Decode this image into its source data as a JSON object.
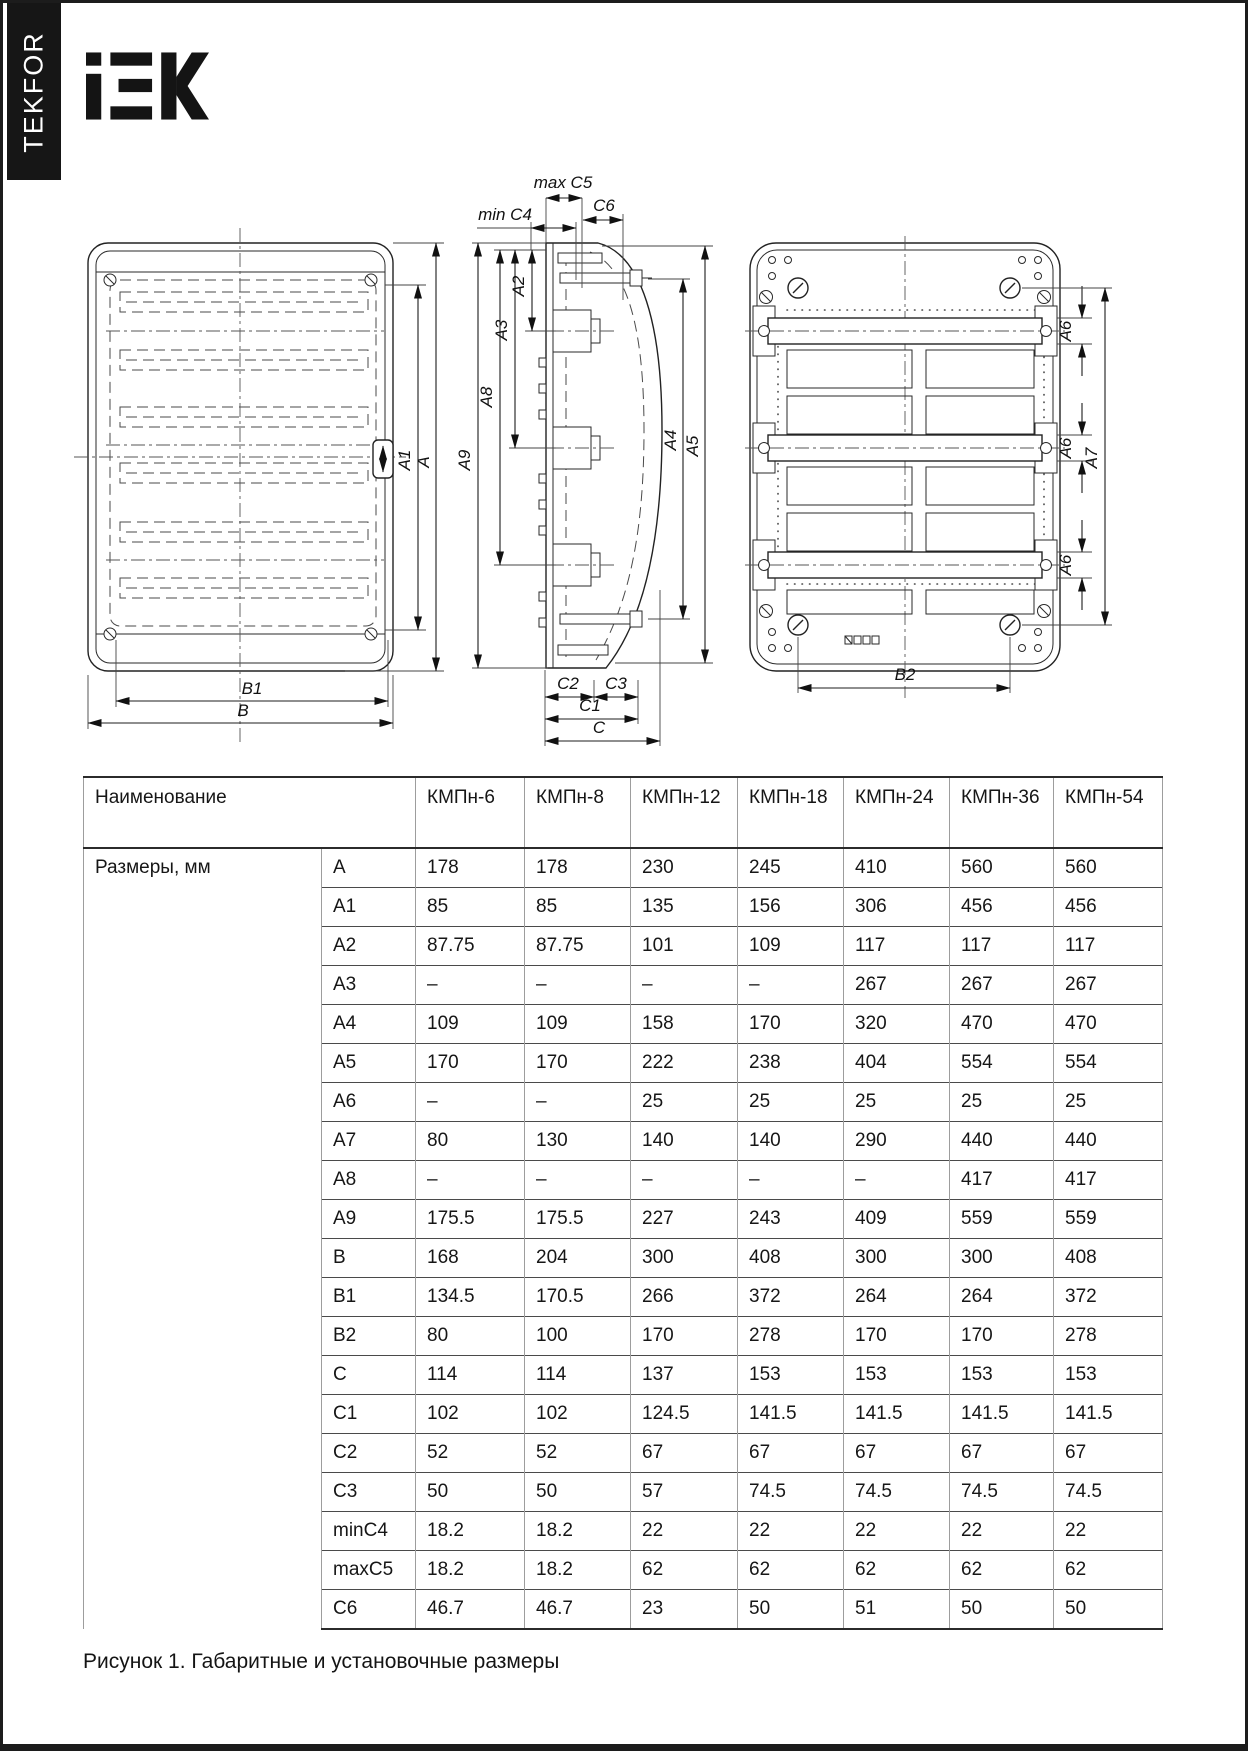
{
  "page": {
    "brand_vertical": "TEKFOR",
    "logo_text": "iEK",
    "caption": "Рисунок 1. Габаритные и установочные размеры"
  },
  "dims": {
    "A": "A",
    "A1": "A1",
    "A2": "A2",
    "A3": "A3",
    "A4": "A4",
    "A5": "A5",
    "A6": "A6",
    "A7": "A7",
    "A8": "A8",
    "A9": "A9",
    "B": "B",
    "B1": "B1",
    "B2": "B2",
    "C": "C",
    "C1": "C1",
    "C2": "C2",
    "C3": "C3",
    "minC4": "min C4",
    "maxC5": "max C5",
    "C6": "C6"
  },
  "table": {
    "name_header": "Наименование",
    "models": [
      "КМПн-6",
      "КМПн-8",
      "КМПн-12",
      "КМПн-18",
      "КМПн-24",
      "КМПн-36",
      "КМПн-54"
    ],
    "group_label": "Размеры, мм",
    "rows": [
      {
        "dim": "A",
        "values": [
          "178",
          "178",
          "230",
          "245",
          "410",
          "560",
          "560"
        ]
      },
      {
        "dim": "A1",
        "values": [
          "85",
          "85",
          "135",
          "156",
          "306",
          "456",
          "456"
        ]
      },
      {
        "dim": "A2",
        "values": [
          "87.75",
          "87.75",
          "101",
          "109",
          "117",
          "117",
          "117"
        ]
      },
      {
        "dim": "A3",
        "values": [
          "–",
          "–",
          "–",
          "–",
          "267",
          "267",
          "267"
        ]
      },
      {
        "dim": "A4",
        "values": [
          "109",
          "109",
          "158",
          "170",
          "320",
          "470",
          "470"
        ]
      },
      {
        "dim": "A5",
        "values": [
          "170",
          "170",
          "222",
          "238",
          "404",
          "554",
          "554"
        ]
      },
      {
        "dim": "A6",
        "values": [
          "–",
          "–",
          "25",
          "25",
          "25",
          "25",
          "25"
        ]
      },
      {
        "dim": "A7",
        "values": [
          "80",
          "130",
          "140",
          "140",
          "290",
          "440",
          "440"
        ]
      },
      {
        "dim": "A8",
        "values": [
          "–",
          "–",
          "–",
          "–",
          "–",
          "417",
          "417"
        ]
      },
      {
        "dim": "A9",
        "values": [
          "175.5",
          "175.5",
          "227",
          "243",
          "409",
          "559",
          "559"
        ]
      },
      {
        "dim": "B",
        "values": [
          "168",
          "204",
          "300",
          "408",
          "300",
          "300",
          "408"
        ]
      },
      {
        "dim": "B1",
        "values": [
          "134.5",
          "170.5",
          "266",
          "372",
          "264",
          "264",
          "372"
        ]
      },
      {
        "dim": "B2",
        "values": [
          "80",
          "100",
          "170",
          "278",
          "170",
          "170",
          "278"
        ]
      },
      {
        "dim": "C",
        "values": [
          "114",
          "114",
          "137",
          "153",
          "153",
          "153",
          "153"
        ]
      },
      {
        "dim": "C1",
        "values": [
          "102",
          "102",
          "124.5",
          "141.5",
          "141.5",
          "141.5",
          "141.5"
        ]
      },
      {
        "dim": "C2",
        "values": [
          "52",
          "52",
          "67",
          "67",
          "67",
          "67",
          "67"
        ]
      },
      {
        "dim": "C3",
        "values": [
          "50",
          "50",
          "57",
          "74.5",
          "74.5",
          "74.5",
          "74.5"
        ]
      },
      {
        "dim": "minC4",
        "values": [
          "18.2",
          "18.2",
          "22",
          "22",
          "22",
          "22",
          "22"
        ]
      },
      {
        "dim": "maxC5",
        "values": [
          "18.2",
          "18.2",
          "62",
          "62",
          "62",
          "62",
          "62"
        ]
      },
      {
        "dim": "C6",
        "values": [
          "46.7",
          "46.7",
          "23",
          "50",
          "51",
          "50",
          "50"
        ]
      }
    ]
  }
}
